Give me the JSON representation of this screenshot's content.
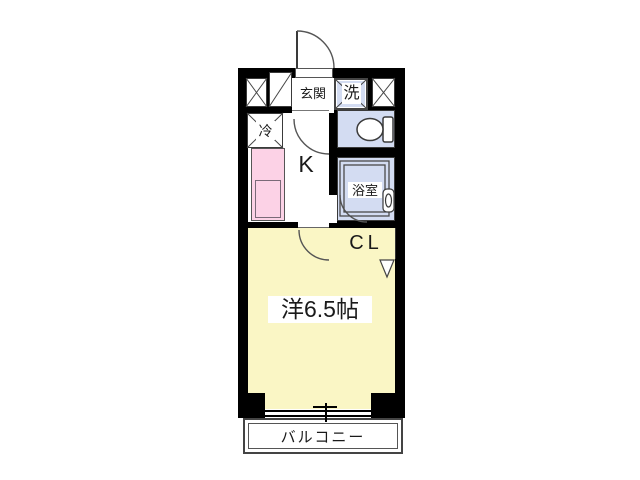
{
  "plan": {
    "type": "apartment-floor-plan",
    "labels": {
      "genkan": "玄関",
      "washer": "洗",
      "fridge": "冷",
      "kitchen": "K",
      "bathroom": "浴室",
      "closet": "CL",
      "main_room": "洋6.5帖",
      "balcony": "バルコニー"
    },
    "colors": {
      "wall": "#000000",
      "room_yellow": "#faf6c5",
      "counter_pink": "#fcd2e6",
      "wet_area_blue": "#d3dcf2",
      "line_gray": "#3a3a3a"
    }
  }
}
